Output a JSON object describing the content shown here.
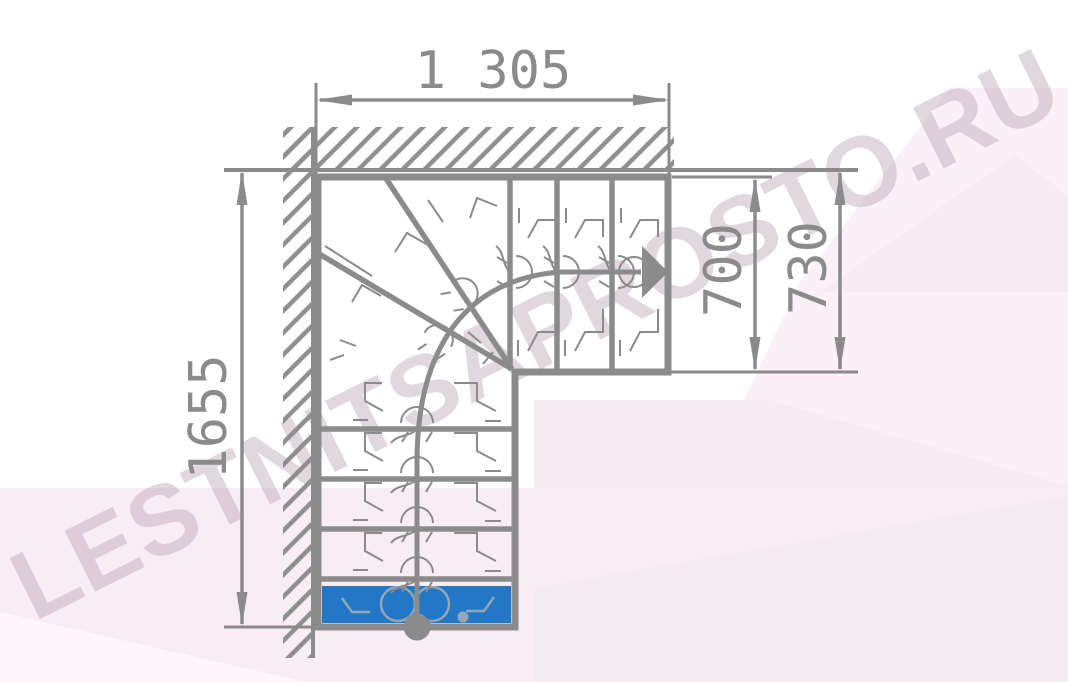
{
  "watermark": {
    "text": "LESTNITSAPROSTO.RU"
  },
  "drawing": {
    "type": "staircase-floor-plan",
    "description": "L-shaped quarter-turn winder staircase plan with walls, walking line and highlighted first step",
    "dimensions": {
      "top_width": "1 305",
      "right_inner": "700",
      "right_outer": "730",
      "left_height": "1655"
    }
  },
  "colors": {
    "line": "#8b8b8b",
    "hatch": "#8f8f8f",
    "accent_step": "#2277c6",
    "scribble": "#93a7b5",
    "watermark": "#b9a3b4",
    "bg_pink_1": "#fbf0f7",
    "bg_pink_2": "#f9edf5",
    "bg_pink_3": "#f4eaf1",
    "bg_pink_4": "#fdf6fa",
    "bg_pink_5": "#f7ebf3"
  }
}
